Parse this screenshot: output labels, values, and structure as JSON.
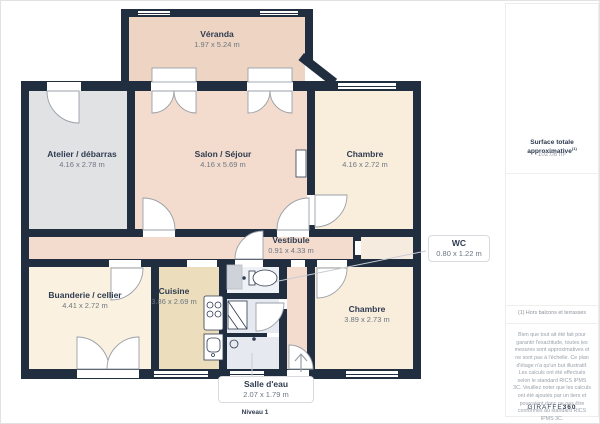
{
  "plan": {
    "level_label": "Niveau 1",
    "rooms": [
      {
        "name": "Véranda",
        "dims": "1.97 x 5.24 m"
      },
      {
        "name": "Atelier / débarras",
        "dims": "4.16 x 2.78 m"
      },
      {
        "name": "Salon / Séjour",
        "dims": "4.16 x 5.69 m"
      },
      {
        "name": "Chambre",
        "dims": "4.16 x 2.72 m"
      },
      {
        "name": "Vestibule",
        "dims": "0.91 x 4.33 m"
      },
      {
        "name": "Buanderie / cellier",
        "dims": "4.41 x 2.72 m"
      },
      {
        "name": "Cuisine",
        "dims": "3.86 x 2.69 m"
      },
      {
        "name": "Chambre",
        "dims": "3.89 x 2.73 m"
      }
    ],
    "callouts": [
      {
        "name": "WC",
        "dims": "0.80 x 1.22 m"
      },
      {
        "name": "Salle d'eau",
        "dims": "2.07 x 1.79 m"
      }
    ]
  },
  "sidebar": {
    "surface_label": "Surface totale approximative",
    "surface_superscript": "(1)",
    "surface_value": "102.08 m²",
    "footnote": "(1) Hors balcons et terrasses",
    "disclaimer_1": "Bien que tout ait été fait pour garantir l'exactitude, toutes les mesures sont approximatives et ne sont pas à l'échelle. Ce plan d'étage n'a qu'un but illustratif.",
    "disclaimer_2": "Les calculs ont été effectués selon le standard RICS IPMS 3C. Veuillez noter que les calculs ont été ajoutés par un tiers et pourraient donc ne pas être conformes au standard RICS IPMS 3C.",
    "brand": "GIRAFFE",
    "brand_suffix": "360"
  },
  "colors": {
    "wall": "#202e40",
    "veranda": "#eed4c3",
    "salon": "#f3dccd",
    "atelier": "#e0e2e4",
    "chambre": "#f9eddc",
    "buanderie": "#faf1e0",
    "cuisine": "#ecdebc",
    "bathroom": "#e6eaf0"
  }
}
